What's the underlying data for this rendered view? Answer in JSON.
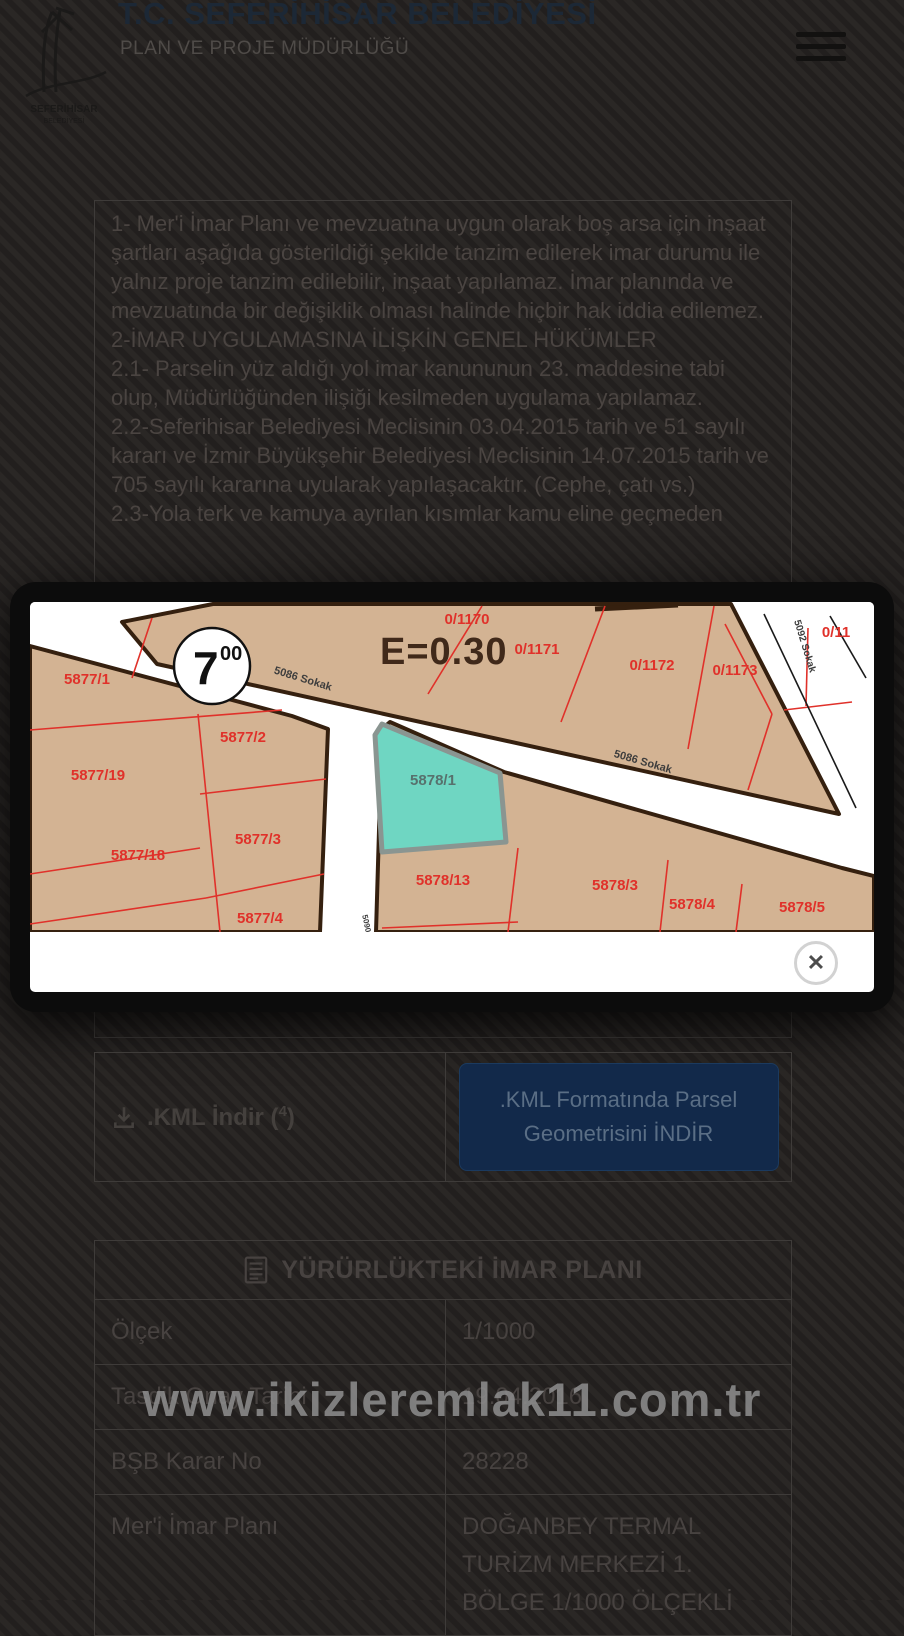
{
  "header": {
    "title": "T.C. SEFERİHİSAR BELEDİYESİ",
    "subtitle": "PLAN VE PROJE MÜDÜRLÜĞÜ"
  },
  "rules": {
    "paragraphs": [
      "1- Mer'i İmar Planı ve mevzuatına uygun olarak boş arsa için inşaat şartları aşağıda gösterildiği şekilde tanzim edilerek imar durumu ile yalnız proje tanzim edilebilir, inşaat yapılamaz. İmar planında ve mevzuatında bir değişiklik olması halinde hiçbir hak iddia edilemez.",
      "2-İMAR UYGULAMASINA İLİŞKİN GENEL HÜKÜMLER",
      "2.1- Parselin yüz aldığı yol imar kanununun 23. maddesine tabi olup, Müdürlüğünden ilişiği kesilmeden uygulama yapılamaz.",
      "2.2-Seferihisar Belediyesi Meclisinin 03.04.2015 tarih ve 51 sayılı kararı ve İzmir Büyükşehir Belediyesi Meclisinin 14.07.2015 tarih ve 705 sayılı kararına uyularak yapılaşacaktır. (Cephe, çatı vs.)",
      "2.3-Yola terk ve kamuya ayrılan kısımlar kamu eline geçmeden"
    ]
  },
  "modal": {
    "close_glyph": "✕"
  },
  "map": {
    "efficiency_label": "E=0.30",
    "circle_main": "7",
    "circle_sup": "00",
    "selected_parcel": "5878/1",
    "parcel_labels": [
      {
        "text": "0/1170",
        "x": 437,
        "y": 22
      },
      {
        "text": "0/1171",
        "x": 507,
        "y": 52
      },
      {
        "text": "0/1172",
        "x": 622,
        "y": 68
      },
      {
        "text": "0/1173",
        "x": 705,
        "y": 73
      },
      {
        "text": "0/11",
        "x": 806,
        "y": 35
      },
      {
        "text": "5877/1",
        "x": 57,
        "y": 82
      },
      {
        "text": "5877/2",
        "x": 213,
        "y": 140
      },
      {
        "text": "5877/19",
        "x": 68,
        "y": 178
      },
      {
        "text": "5877/18",
        "x": 108,
        "y": 258
      },
      {
        "text": "5877/3",
        "x": 228,
        "y": 242
      },
      {
        "text": "5877/4",
        "x": 230,
        "y": 321
      },
      {
        "text": "5878/13",
        "x": 413,
        "y": 283
      },
      {
        "text": "5878/3",
        "x": 585,
        "y": 288
      },
      {
        "text": "5878/4",
        "x": 662,
        "y": 307
      },
      {
        "text": "5878/5",
        "x": 772,
        "y": 310
      }
    ],
    "street_labels": [
      {
        "text": "5086 Sokak",
        "x": 272,
        "y": 80,
        "rot": 17,
        "size": 11
      },
      {
        "text": "5086 Sokak",
        "x": 612,
        "y": 163,
        "rot": 16,
        "size": 11
      },
      {
        "text": "5092 Sokak",
        "x": 772,
        "y": 45,
        "rot": 73,
        "size": 10
      },
      {
        "text": "5090",
        "x": 334,
        "y": 322,
        "rot": 78,
        "size": 8
      }
    ],
    "colors": {
      "parcel_fill": "#d3b393",
      "road_casing": "#35200f",
      "parcel_line": "#e0312a",
      "selected_fill": "#6fd6c2",
      "selected_border": "#8a9591"
    }
  },
  "downloads": {
    "kml_label": ".KML İndir",
    "kml_count": "4",
    "kml_button": ".KML Formatında Parsel Geometrisini İNDİR"
  },
  "imar_table": {
    "title": "YÜRÜRLÜKTEKİ İMAR PLANI",
    "rows": [
      {
        "label": "Ölçek",
        "value": "1/1000"
      },
      {
        "label": "Tasdik Onay Tarihi",
        "value": "19.04.2016"
      },
      {
        "label": "BŞB Karar No",
        "value": "28228"
      },
      {
        "label": "Mer'i İmar Planı",
        "value": "DOĞANBEY TERMAL TURİZM MERKEZİ 1. BÖLGE 1/1000 ÖLÇEKLİ"
      }
    ]
  },
  "watermark": {
    "text": "www.ikizleremlak11.com.tr"
  }
}
